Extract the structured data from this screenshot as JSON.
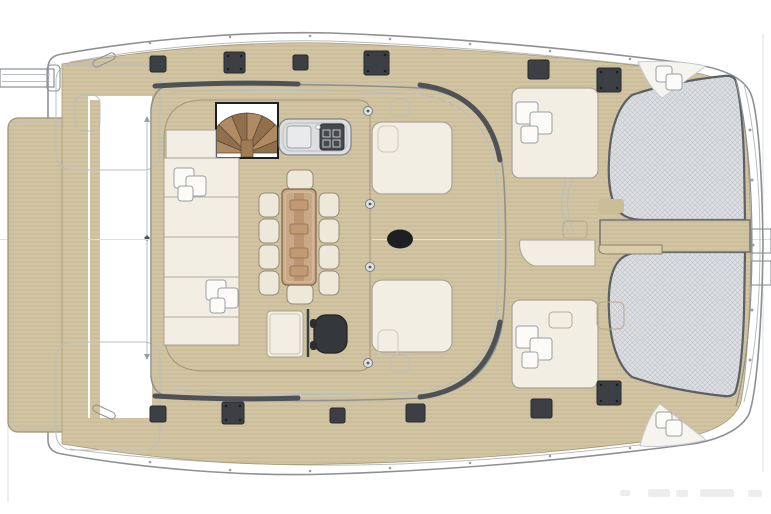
{
  "plan": {
    "subject": "catamaran-main-deck-plan",
    "orientation": {
      "bow": "right",
      "stern": "left",
      "port": "top",
      "starboard": "bottom"
    },
    "features": {
      "trampolines": 2,
      "deck_hatches": 12,
      "dining_chairs": 10,
      "sun_pads": 4,
      "bow_corner_seats": 2,
      "side_table_clusters": 6,
      "spiral_staircase": 1,
      "galley_counter": 1,
      "desk_with_office_chair": 1,
      "windshield_seat_panels": 2,
      "aft_davit_arm": 1
    },
    "watermark": {
      "legible": false,
      "position": "bottom-right"
    }
  },
  "colors": {
    "teak": "#d2c5a2",
    "teakLine": "#b4a783",
    "tramp": "#dcdee1",
    "trampLine": "#c0c3c8",
    "cushion": "#f2eee3",
    "cushionEdge": "#aba295",
    "outline": "#8d9194",
    "outlineLight": "#b9bdbf",
    "shadow": "#4e5256",
    "hatch": "#3c4044",
    "ink": "#1d2023",
    "stairWoodA": "#b08a62",
    "stairWoodB": "#8f6f4c",
    "tableWood": "#c9a887",
    "counter": "#dcdedf"
  }
}
